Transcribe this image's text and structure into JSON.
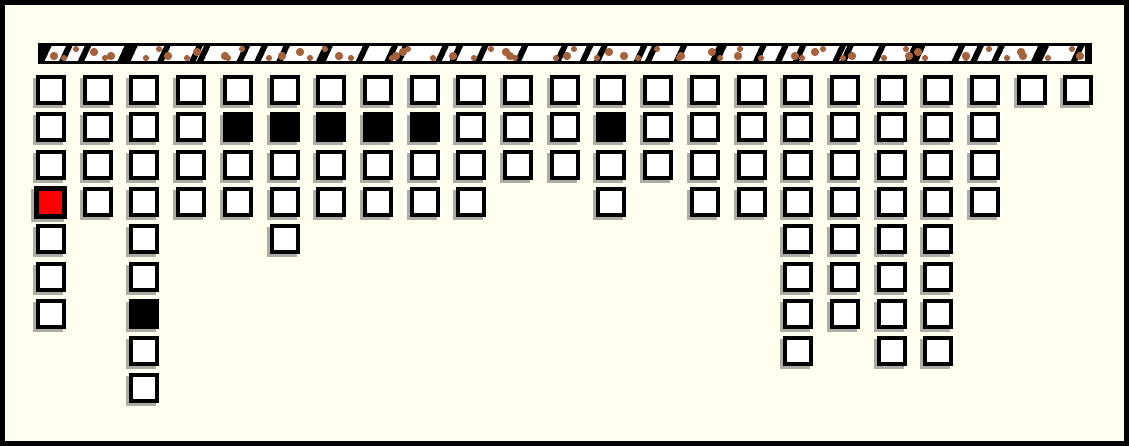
{
  "app": {
    "description": "peg board of square cells hanging from a speckled rail"
  },
  "colors": {
    "background": "#FFFFF0",
    "ink": "#000000",
    "cell_empty": "#FFFFFF",
    "cell_filled": "#000000",
    "cell_selected": "#FF0000",
    "rail_base": "#FFFFFF",
    "rail_spot_brown": "#A5623B",
    "shadow": "rgba(70,70,70,0.45)"
  },
  "board": {
    "column_count": 23,
    "cell_states_legend": [
      "empty",
      "filled",
      "selected"
    ],
    "columns": [
      {
        "index": 1,
        "cells": [
          "empty",
          "empty",
          "empty",
          "selected",
          "empty",
          "empty",
          "empty"
        ]
      },
      {
        "index": 2,
        "cells": [
          "empty",
          "empty",
          "empty",
          "empty"
        ]
      },
      {
        "index": 3,
        "cells": [
          "empty",
          "empty",
          "empty",
          "empty",
          "empty",
          "empty",
          "filled",
          "empty",
          "empty"
        ]
      },
      {
        "index": 4,
        "cells": [
          "empty",
          "empty",
          "empty",
          "empty"
        ]
      },
      {
        "index": 5,
        "cells": [
          "empty",
          "filled",
          "empty",
          "empty"
        ]
      },
      {
        "index": 6,
        "cells": [
          "empty",
          "filled",
          "empty",
          "empty",
          "empty"
        ]
      },
      {
        "index": 7,
        "cells": [
          "empty",
          "filled",
          "empty",
          "empty"
        ]
      },
      {
        "index": 8,
        "cells": [
          "empty",
          "filled",
          "empty",
          "empty"
        ]
      },
      {
        "index": 9,
        "cells": [
          "empty",
          "filled",
          "empty",
          "empty"
        ]
      },
      {
        "index": 10,
        "cells": [
          "empty",
          "empty",
          "empty",
          "empty"
        ]
      },
      {
        "index": 11,
        "cells": [
          "empty",
          "empty",
          "empty"
        ]
      },
      {
        "index": 12,
        "cells": [
          "empty",
          "empty",
          "empty"
        ]
      },
      {
        "index": 13,
        "cells": [
          "empty",
          "filled",
          "empty",
          "empty"
        ]
      },
      {
        "index": 14,
        "cells": [
          "empty",
          "empty",
          "empty"
        ]
      },
      {
        "index": 15,
        "cells": [
          "empty",
          "empty",
          "empty",
          "empty"
        ]
      },
      {
        "index": 16,
        "cells": [
          "empty",
          "empty",
          "empty",
          "empty"
        ]
      },
      {
        "index": 17,
        "cells": [
          "empty",
          "empty",
          "empty",
          "empty",
          "empty",
          "empty",
          "empty",
          "empty"
        ]
      },
      {
        "index": 18,
        "cells": [
          "empty",
          "empty",
          "empty",
          "empty",
          "empty",
          "empty",
          "empty"
        ]
      },
      {
        "index": 19,
        "cells": [
          "empty",
          "empty",
          "empty",
          "empty",
          "empty",
          "empty",
          "empty",
          "empty"
        ]
      },
      {
        "index": 20,
        "cells": [
          "empty",
          "empty",
          "empty",
          "empty",
          "empty",
          "empty",
          "empty",
          "empty"
        ]
      },
      {
        "index": 21,
        "cells": [
          "empty",
          "empty",
          "empty",
          "empty"
        ]
      },
      {
        "index": 22,
        "cells": [
          "empty"
        ]
      },
      {
        "index": 23,
        "cells": [
          "empty"
        ]
      }
    ]
  }
}
